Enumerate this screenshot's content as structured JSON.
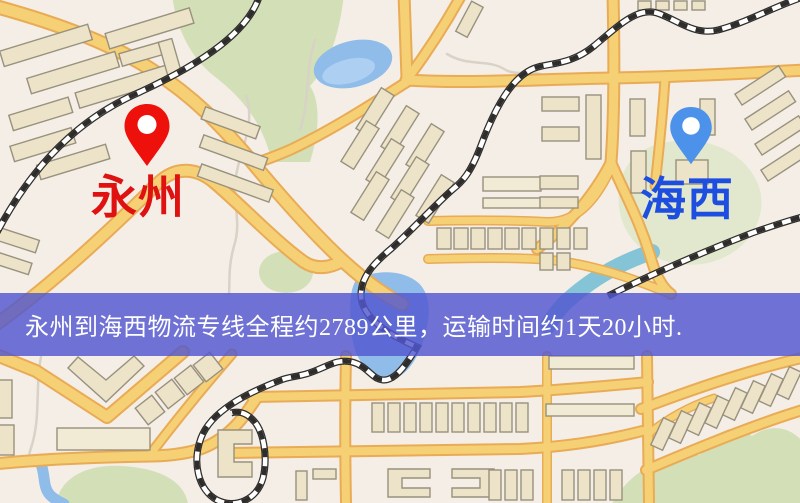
{
  "origin": {
    "label": "永州"
  },
  "destination": {
    "label": "海西"
  },
  "banner": {
    "text": "永州到海西物流专线全程约2789公里，运输时间约1天20小时."
  },
  "icons": {
    "origin_pin": "red-map-pin",
    "destination_pin": "blue-map-pin"
  },
  "colors": {
    "bg": "#f4eee7",
    "park": "#d3dfb7",
    "park_light": "#e1e8cd",
    "water": "#8fbce8",
    "water_light": "#accff2",
    "water_teal": "#85c4d6",
    "trail": "#d8d2c7",
    "road": "#f6d075",
    "road_casing": "#e9ab55",
    "building": "#ece3c9",
    "building_light": "#f1ead4",
    "building_stroke": "#98917d",
    "rail_dark": "#2e2d2b",
    "rail_light": "#ffffff",
    "banner_bg": "#5257cf",
    "banner_text": "#ffffff",
    "origin_pin": "#ee100a",
    "origin_text": "#e01111",
    "dest_pin": "#4d92ea",
    "dest_text": "#1d4ee0"
  }
}
